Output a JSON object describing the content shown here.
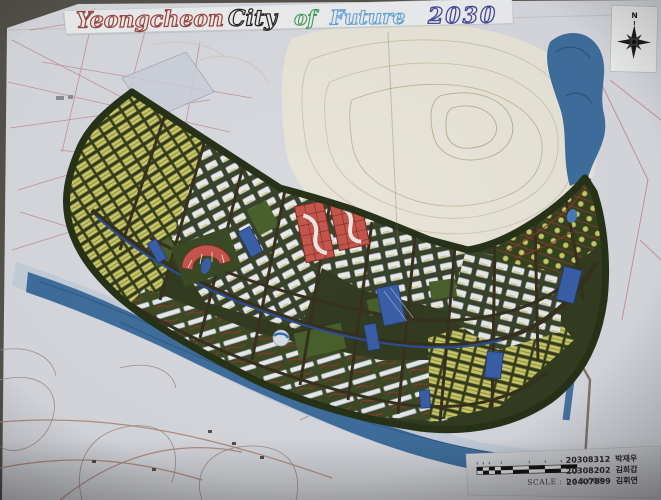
{
  "title": {
    "words": [
      {
        "text": "Yeongcheon",
        "color": "#9a4440"
      },
      {
        "text": "City",
        "color": "#222222"
      },
      {
        "text": "of",
        "color": "#3f9e63"
      },
      {
        "text": "Future",
        "color": "#64a7d9"
      },
      {
        "text": "2030",
        "color": "#474a9b"
      }
    ]
  },
  "compass": {
    "label": "N"
  },
  "info_card": {
    "scale_label": "SCALE : 1 / 3,000",
    "credits": [
      {
        "id": "20308312",
        "name": "박재우"
      },
      {
        "id": "20308202",
        "name": "김희갑"
      },
      {
        "id": "20407899",
        "name": "김휘연"
      }
    ]
  },
  "map": {
    "colors": {
      "poster_base": "#d7d9df",
      "river": "#3f6f9e",
      "floodplain": "#c2ccd9",
      "development_base": "#333c20",
      "residential_yellow": "#c9c868",
      "apartment_white": "#e8e9ee",
      "commercial_red": "#c4554c",
      "public_blue": "#3a5fa8",
      "park_green": "#49602c",
      "road": "#38301f",
      "canal": "#2c4f92",
      "hill": "#e8e5d8",
      "cadastral_pink": "#c08890"
    }
  }
}
